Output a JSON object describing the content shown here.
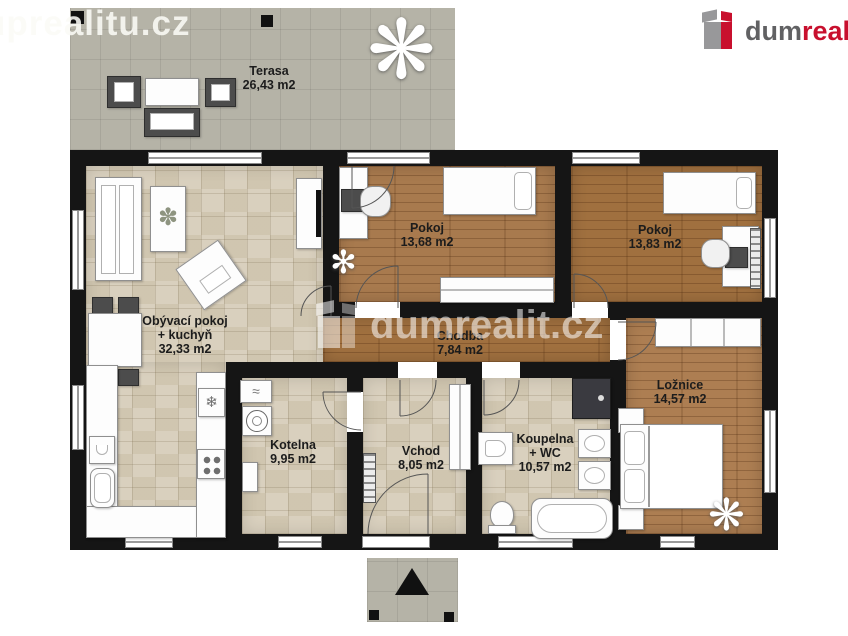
{
  "watermarks": {
    "top_left": "uprealitu.cz",
    "center": "dumrealit.cz"
  },
  "brand": {
    "part_gray": "dum",
    "part_red": "realit",
    "part_suffix": ".cz"
  },
  "rooms": [
    {
      "id": "terasa",
      "name": "Terasa",
      "area": "26,43 m2"
    },
    {
      "id": "obyvaci-pokoj-kuchyn",
      "name": "Obývací pokoj",
      "name2": "+ kuchyň",
      "area": "32,33 m2"
    },
    {
      "id": "pokoj-1",
      "name": "Pokoj",
      "area": "13,68 m2"
    },
    {
      "id": "pokoj-2",
      "name": "Pokoj",
      "area": "13,83 m2"
    },
    {
      "id": "chodba",
      "name": "Chodba",
      "area": "7,84 m2"
    },
    {
      "id": "loznice",
      "name": "Ložnice",
      "area": "14,57 m2"
    },
    {
      "id": "kotelna",
      "name": "Kotelna",
      "area": "9,95 m2"
    },
    {
      "id": "vchod",
      "name": "Vchod",
      "area": "8,05 m2"
    },
    {
      "id": "koupelna-wc",
      "name": "Koupelna",
      "name2": "+ WC",
      "area": "10,57 m2"
    }
  ],
  "icons": {
    "fridge_snowflake": "❄",
    "plant_large": "❋",
    "plant_small": "✻",
    "table_plant": "✽",
    "boiler_heat": "≈"
  },
  "compass": {
    "direction": "north",
    "symbol": "▲"
  },
  "colors": {
    "wall": "#151515",
    "tile_floor": "#d7ceba",
    "wood_floor": "#a87a4e",
    "terrace": "#b5b3a7",
    "brand_red": "#c8102e",
    "brand_gray": "#616163"
  }
}
